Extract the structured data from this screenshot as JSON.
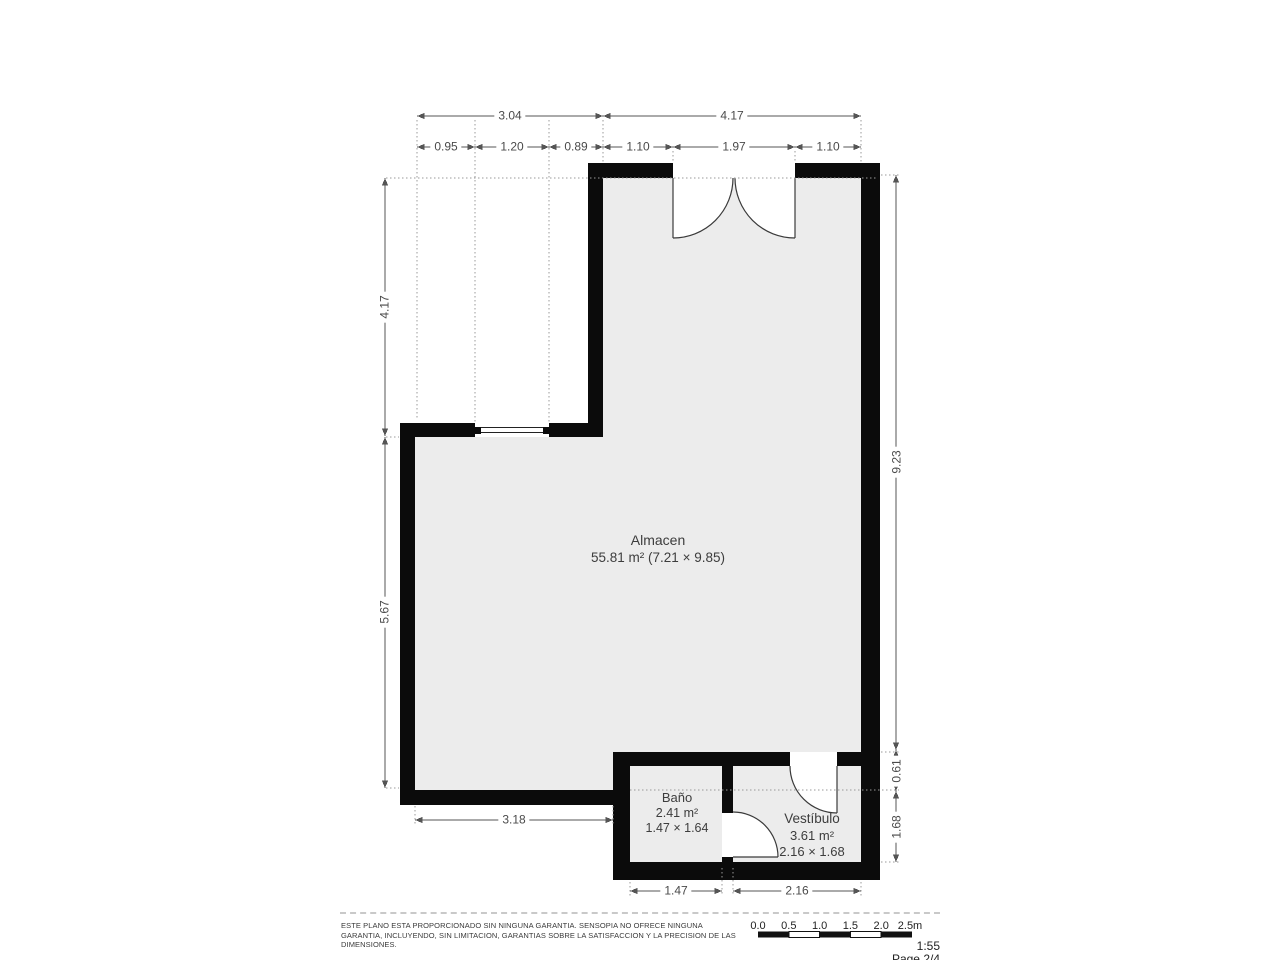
{
  "plan": {
    "rooms": {
      "almacen": {
        "name": "Almacen",
        "details": "55.81 m² (7.21 × 9.85)"
      },
      "bano": {
        "name": "Baño",
        "area": "2.41 m²",
        "size": "1.47 × 1.64"
      },
      "vestibulo": {
        "name": "Vestíbulo",
        "area": "3.61 m²",
        "size": "2.16 × 1.68"
      }
    },
    "dims": {
      "top_left": "3.04",
      "top_right": "4.17",
      "sub1": "0.95",
      "sub2": "1.20",
      "sub3": "0.89",
      "sub4": "1.10",
      "sub5": "1.97",
      "sub6": "1.10",
      "left_upper": "4.17",
      "left_lower": "5.67",
      "right_main": "9.23",
      "right_small": "0.61",
      "right_lower": "1.68",
      "bottom_left": "3.18",
      "bottom_bano": "1.47",
      "bottom_vestibulo": "2.16"
    },
    "colors": {
      "wall": "#0b0b0b",
      "floor": "#ececec",
      "dim_line": "#555555",
      "ext_line": "#999999"
    }
  },
  "footer": {
    "disclaimer_line1": "ESTE PLANO ESTA PROPORCIONADO SIN NINGUNA GARANTIA. SENSOPIA NO OFRECE NINGUNA",
    "disclaimer_line2": "GARANTIA, INCLUYENDO, SIN LIMITACION, GARANTIAS SOBRE LA SATISFACCION Y LA PRECISION DE LAS",
    "disclaimer_line3": "DIMENSIONES.",
    "scale_labels": [
      "0.0",
      "0.5",
      "1.0",
      "1.5",
      "2.0",
      "2.5m"
    ],
    "scale_ratio": "1:55",
    "page_indicator": "Page 2/4"
  }
}
